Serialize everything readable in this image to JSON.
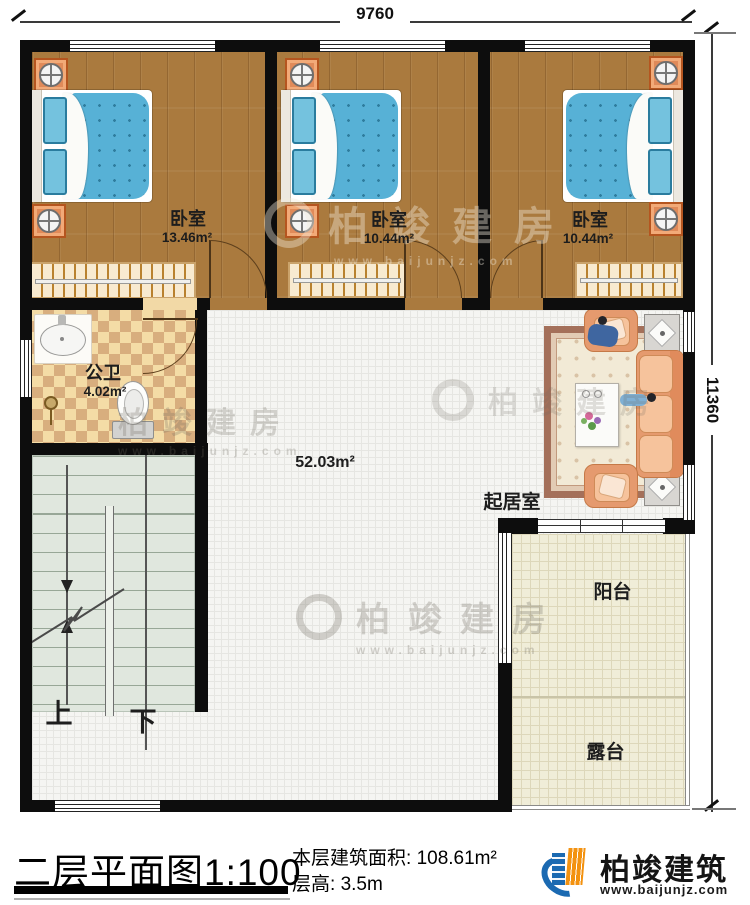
{
  "dimensions": {
    "top": "9760",
    "right": "11360"
  },
  "rooms": {
    "bedroom1": {
      "name": "卧室",
      "area": "13.46m²"
    },
    "bedroom2": {
      "name": "卧室",
      "area": "10.44m²"
    },
    "bedroom3": {
      "name": "卧室",
      "area": "10.44m²"
    },
    "bathroom": {
      "name": "公卫",
      "area": "4.02m²"
    },
    "hall": {
      "area": "52.03m²"
    },
    "living_room": {
      "name": "起居室"
    },
    "balcony": {
      "name": "阳台"
    },
    "terrace": {
      "name": "露台"
    }
  },
  "stairs": {
    "up_label": "上",
    "down_label": "下"
  },
  "title_block": {
    "plan_title": "二层平面图",
    "scale": "1:100",
    "area_label": "本层建筑面积:",
    "area_value": "108.61m²",
    "floor_height_label": "层高:",
    "floor_height_value": "3.5m"
  },
  "brand": {
    "name": "柏竣建筑",
    "website": "www.baijunjz.com"
  },
  "watermark": {
    "text": "柏竣建房",
    "url": "www.baijunjz.com"
  },
  "colors": {
    "wall": "#0d0d0d",
    "wood_floor": "#aa7a3e",
    "bed_blue": "#57b1d6",
    "sofa_peach": "#e59a6e",
    "brand_blue": "#1b6ab2",
    "brand_orange": "#f39210"
  }
}
